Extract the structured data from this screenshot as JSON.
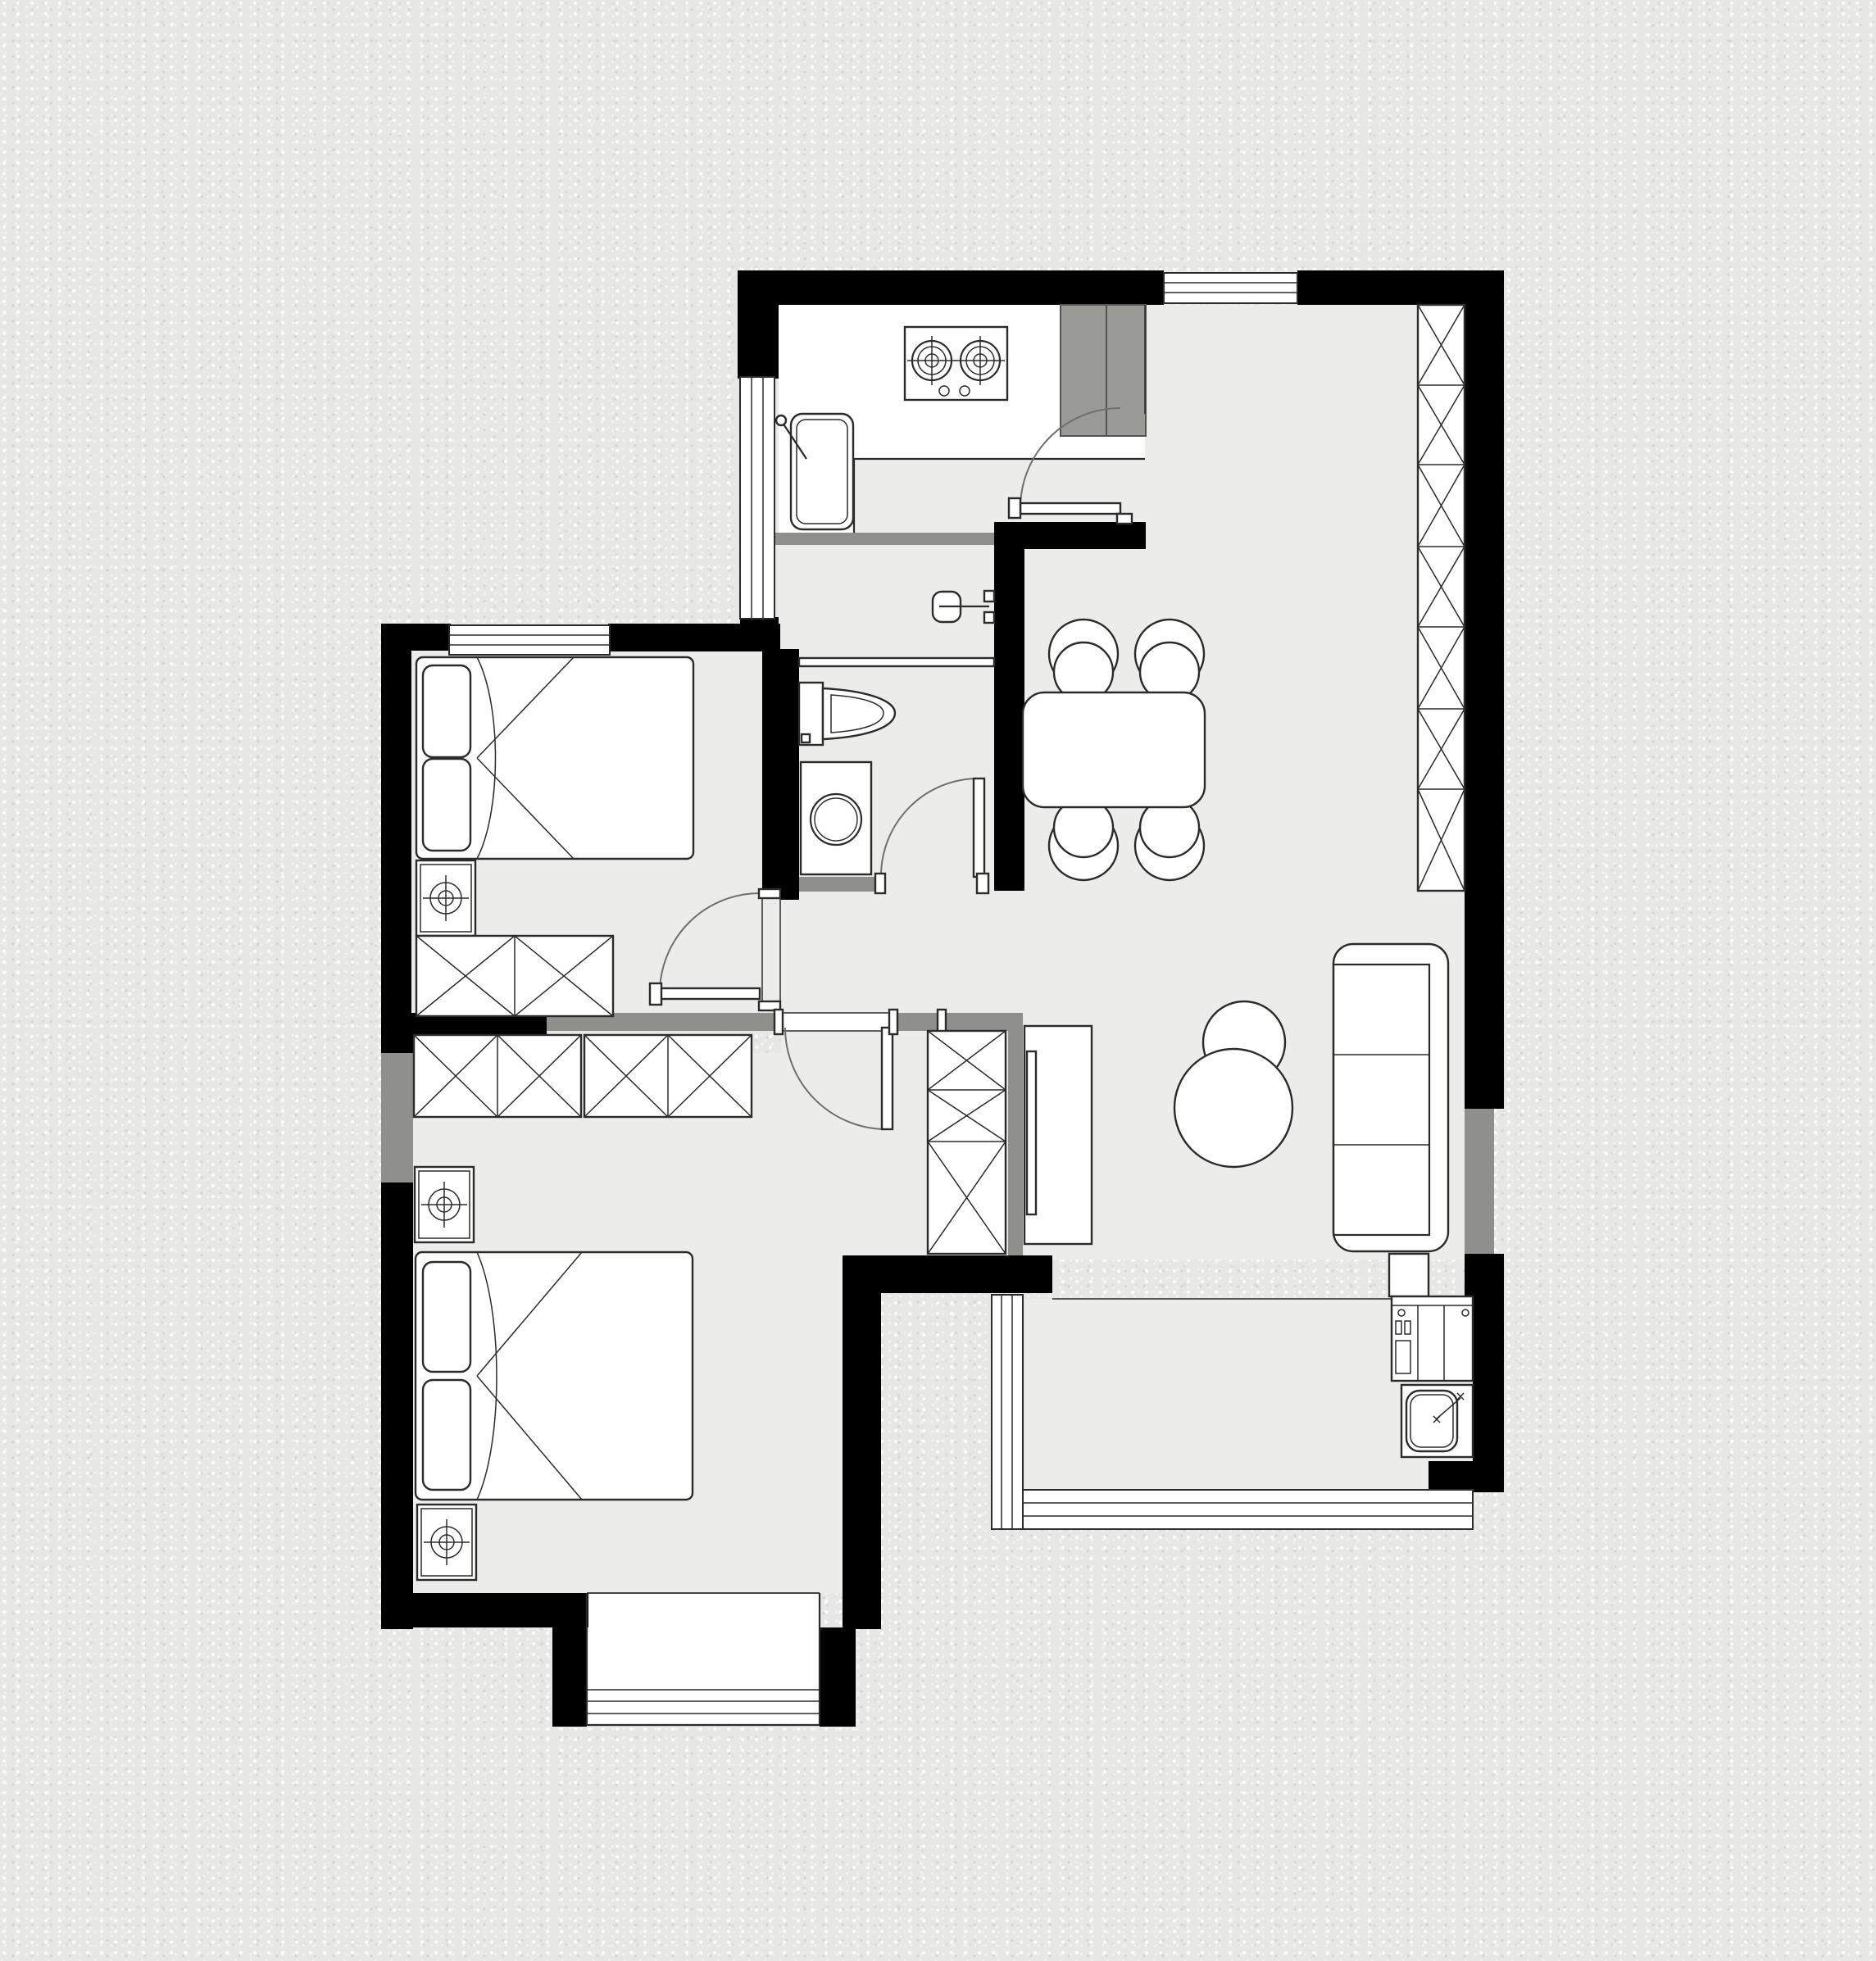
{
  "document": {
    "kind": "architectural-floor-plan",
    "description": "Top-down CAD floor plan of a two-bedroom apartment with kitchen, bathroom, living-dining room, balcony and bay window. No text labels are rendered on the drawing.",
    "visible_text": []
  },
  "palette": {
    "wall": "#000000",
    "wallg": "#8f8f8b",
    "floor": "#ececea",
    "ink": "#2b2b2b",
    "appl": "#9a9a96",
    "background": "#e7e7e6",
    "fixture_fill": "#ffffff",
    "door_arc": "#6f6f6c"
  },
  "rooms": [
    {
      "name": "kitchen",
      "fixtures": [
        "counter",
        "gas-stove",
        "kitchen-sink",
        "fridge",
        "kitchen-door"
      ]
    },
    {
      "name": "living-dining-room",
      "fixtures": [
        "dining-table",
        "dining-chair-x4",
        "tall-storage-column",
        "sofa",
        "coffee-table",
        "tv-stand",
        "tv",
        "side-table"
      ]
    },
    {
      "name": "bathroom",
      "fixtures": [
        "shower-head",
        "shower-screen",
        "toilet",
        "washing-machine",
        "bathroom-door"
      ]
    },
    {
      "name": "bedroom-top",
      "fixtures": [
        "double-bed",
        "pillow-x2",
        "nightstand",
        "wardrobe-2-cell",
        "bedroom-door",
        "window"
      ]
    },
    {
      "name": "bedroom-bottom",
      "fixtures": [
        "double-bed",
        "pillow-x2",
        "nightstand-x2",
        "wardrobe-4-cell",
        "shoe-cabinet-3-cell",
        "bedroom-door",
        "bay-window"
      ]
    },
    {
      "name": "balcony",
      "fixtures": [
        "laundry-appliance",
        "laundry-sink",
        "window-band"
      ]
    },
    {
      "name": "hallway",
      "fixtures": []
    }
  ],
  "symbol_legend": [
    {
      "icon": "x-cell",
      "meaning": "cabinet / wardrobe unit"
    },
    {
      "icon": "target-circle",
      "meaning": "nightstand"
    },
    {
      "icon": "quarter-arc",
      "meaning": "door swing"
    },
    {
      "icon": "triple-line-band",
      "meaning": "window glazing"
    },
    {
      "icon": "concentric-rings",
      "meaning": "stove burner / washer drum"
    }
  ]
}
